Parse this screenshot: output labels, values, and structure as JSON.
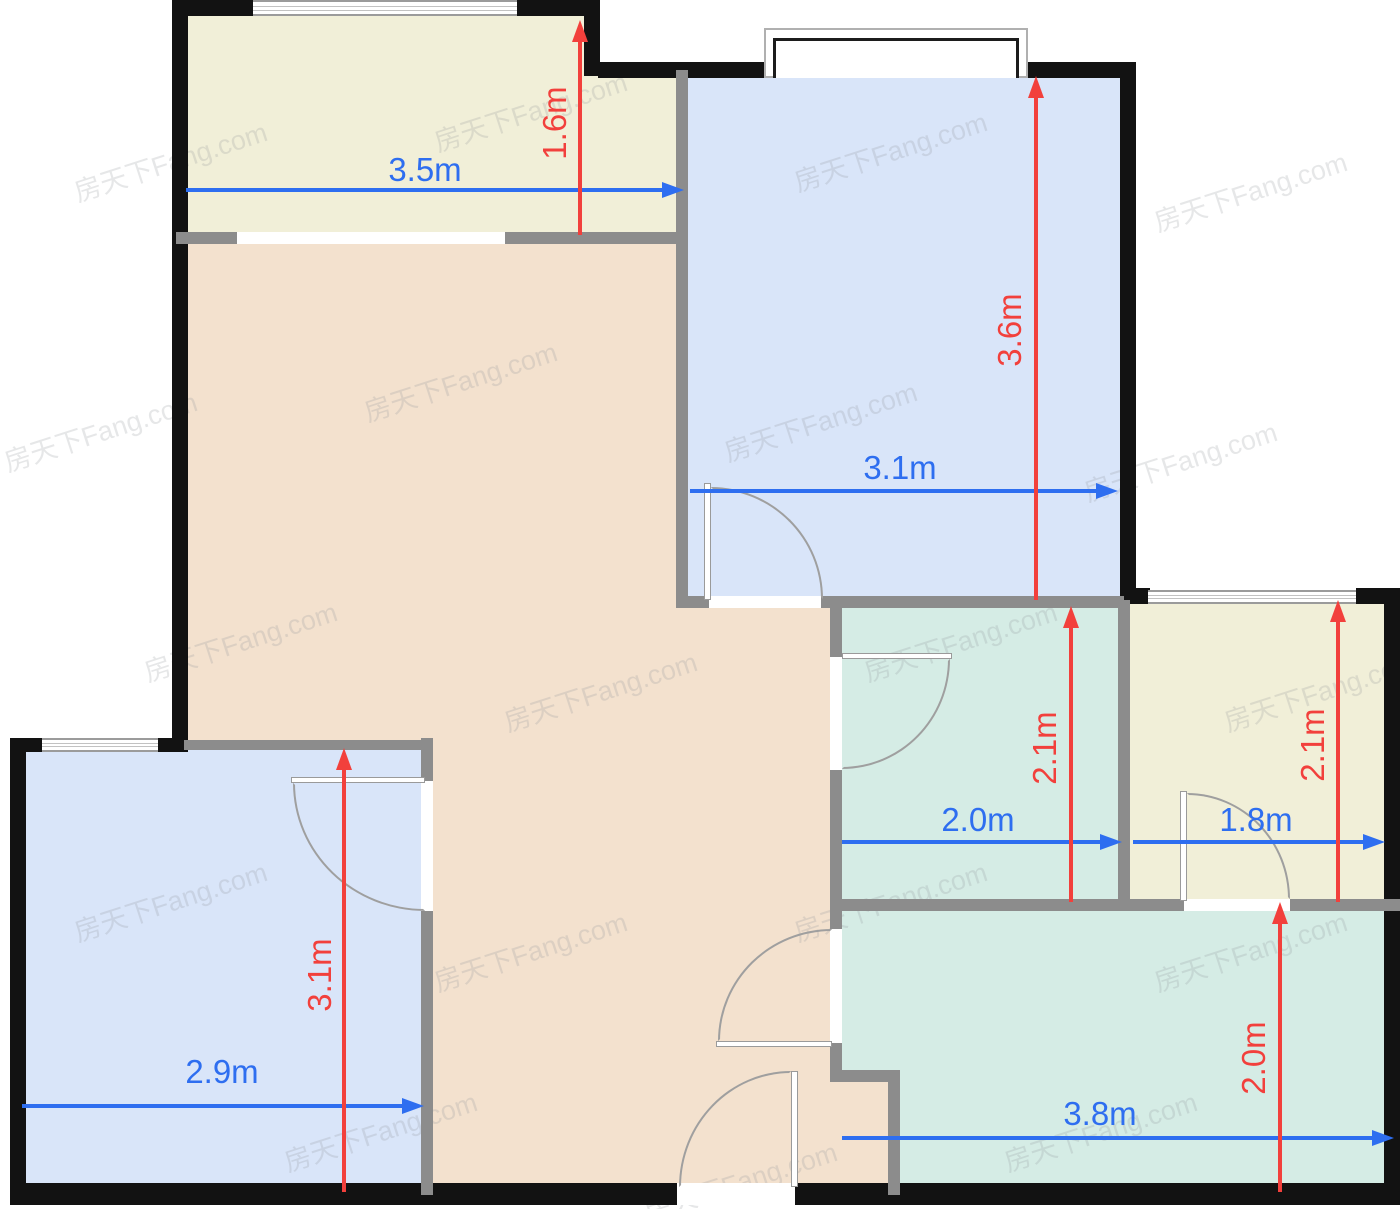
{
  "watermark": {
    "text": "房天下Fang.com"
  },
  "colors": {
    "wall_outer": "#121212",
    "wall_inner": "#8c8c8c",
    "dim_blue": "#2e6ef0",
    "dim_red": "#f2403c",
    "balcony_fill": "#f1efd8",
    "bedroom_fill": "#d9e5f9",
    "living_fill": "#f3e1ce",
    "teal_fill": "#d5ece5"
  },
  "rooms": {
    "balcony": {
      "width": "3.5m",
      "depth": "1.6m",
      "fill": "#f1efd8"
    },
    "bedroom_top": {
      "width": "3.1m",
      "depth": "3.6m",
      "fill": "#d9e5f9"
    },
    "bedroom_bottom": {
      "width": "2.9m",
      "depth": "3.1m",
      "fill": "#d9e5f9"
    },
    "bath_middle": {
      "width": "2.0m",
      "depth": "2.1m",
      "fill": "#d5ece5"
    },
    "room_right": {
      "width": "1.8m",
      "depth": "2.1m",
      "fill": "#f1efd8"
    },
    "kitchen_bottom": {
      "width": "3.8m",
      "depth": "2.0m",
      "fill": "#d5ece5"
    },
    "living": {
      "fill": "#f3e1ce"
    }
  }
}
